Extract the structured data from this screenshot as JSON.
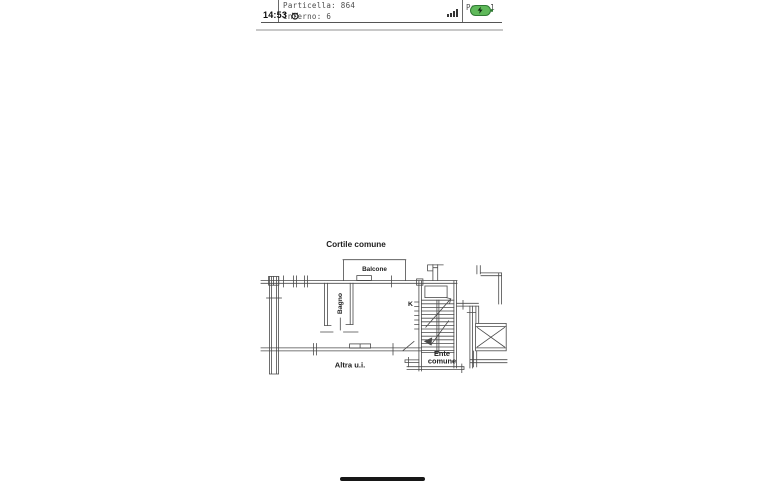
{
  "status_bar": {
    "time": "14:53",
    "icons": {
      "alarm": "alarm-clock",
      "signal": "cellular-signal-bars",
      "battery": "battery-charging-green"
    },
    "battery_color": "#5fb95a"
  },
  "document": {
    "field_particella": "Particella: 864",
    "field_interno": "Interno: 6",
    "page_label": "Pag. 1"
  },
  "floor_plan": {
    "labels": {
      "courtyard": "Cortile comune",
      "balcony": "Balcone",
      "bathroom": "Bagno",
      "kitchen": "K",
      "stair_core_line1": "Ente",
      "stair_core_line2": "comune",
      "other_unit": "Altra u.i."
    },
    "line_color": "#4a4a4a"
  }
}
